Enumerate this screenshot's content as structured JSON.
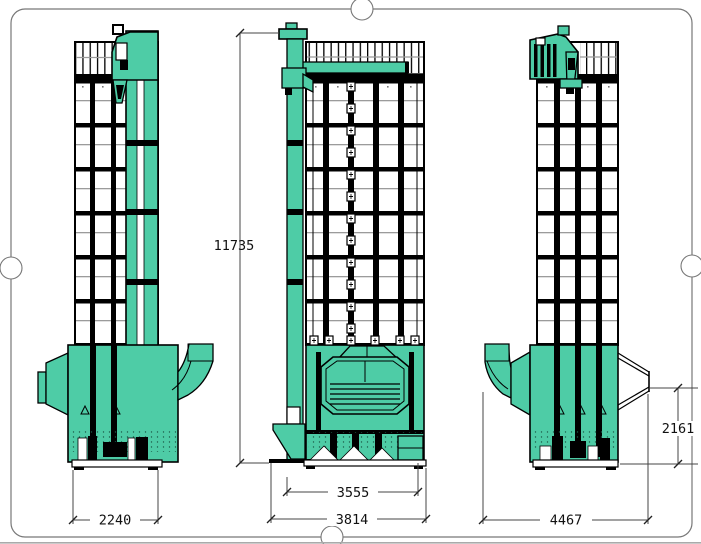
{
  "page": {
    "type": "cad-engineering-drawing",
    "subject": "tower grain dryer, three orthographic views"
  },
  "dimensions": {
    "total_height": "11735",
    "left_view_base_width": "2240",
    "front_view_inner_width": "3555",
    "front_view_overall_width": "3814",
    "right_view_overall_width": "4467",
    "right_view_base_height": "2161"
  },
  "colors": {
    "machine_teal": "#4ECCA6",
    "line_black": "#000000",
    "grid_gray": "#9B9B9B",
    "frame_gray": "#777777",
    "paper_white": "#FFFFFF"
  }
}
